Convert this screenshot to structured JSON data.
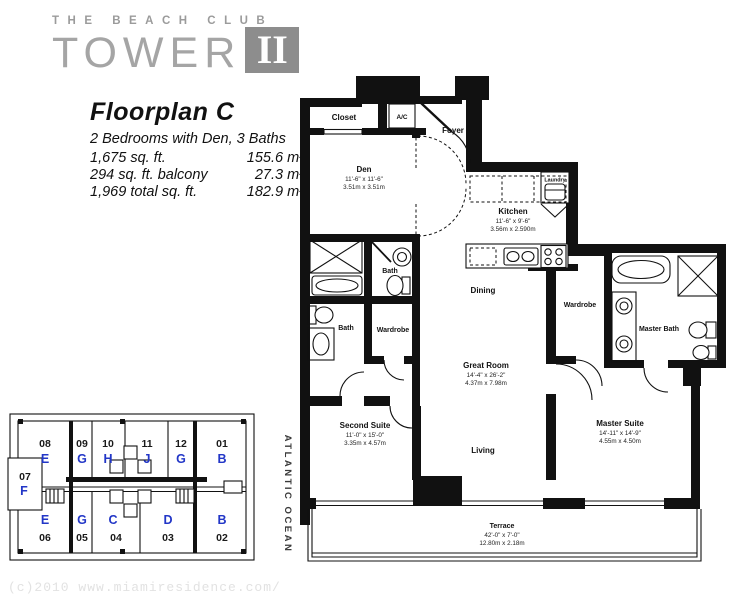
{
  "logo": {
    "tagline": "THE BEACH CLUB",
    "title": "TOWER",
    "numeral": "II"
  },
  "info": {
    "title": "Floorplan C",
    "subtitle": "2 Bedrooms with Den, 3 Baths",
    "area_rows": [
      {
        "left": "1,675 sq. ft.",
        "right": "155.6 m²"
      },
      {
        "left": "294 sq. ft. balcony",
        "right": "27.3 m²"
      },
      {
        "left": "1,969 total sq. ft.",
        "right": "182.9 m²"
      }
    ]
  },
  "plan": {
    "rooms": {
      "closet": {
        "name": "Closet"
      },
      "ac": {
        "name": "A/C"
      },
      "foyer": {
        "name": "Foyer"
      },
      "den": {
        "name": "Den",
        "dims_ft": "11'-6\" x 11'-6\"",
        "dims_m": "3.51m x 3.51m"
      },
      "kitchen": {
        "name": "Kitchen",
        "dims_ft": "11'-6\" x 9'-6\"",
        "dims_m": "3.56m x 2.590m"
      },
      "laundry": {
        "name": "Laundry"
      },
      "bath_upper": {
        "name": "Bath"
      },
      "bath_lower": {
        "name": "Bath"
      },
      "wardrobe_second": {
        "name": "Wardrobe"
      },
      "dining": {
        "name": "Dining"
      },
      "great_room": {
        "name": "Great Room",
        "dims_ft": "14'-4\" x 26'-2\"",
        "dims_m": "4.37m x 7.98m"
      },
      "living": {
        "name": "Living"
      },
      "second_suite": {
        "name": "Second Suite",
        "dims_ft": "11'-0\" x 15'-0\"",
        "dims_m": "3.35m x 4.57m"
      },
      "wardrobe_master": {
        "name": "Wardrobe"
      },
      "master_bath": {
        "name": "Master Bath"
      },
      "master_suite": {
        "name": "Master Suite",
        "dims_ft": "14'-11\" x 14'-9\"",
        "dims_m": "4.55m x 4.50m"
      },
      "terrace": {
        "name": "Terrace",
        "dims_ft": "42'-0\" x 7'-0\"",
        "dims_m": "12.80m x 2.18m"
      }
    },
    "ocean_label": "ATLANTIC OCEAN"
  },
  "keyplan": {
    "top_row": [
      {
        "num": "08",
        "letter": "E"
      },
      {
        "num": "09",
        "letter": "G"
      },
      {
        "num": "10",
        "letter": "H"
      },
      {
        "num": "11",
        "letter": "J"
      },
      {
        "num": "12",
        "letter": "G"
      },
      {
        "num": "01",
        "letter": "B"
      }
    ],
    "left_unit": {
      "num": "07",
      "letter": "F"
    },
    "bottom_row": [
      {
        "letter": "E",
        "num": "06"
      },
      {
        "letter": "G",
        "num": "05"
      },
      {
        "letter": "C",
        "num": "04"
      },
      {
        "letter": "D",
        "num": "03"
      },
      {
        "letter": "B",
        "num": "02"
      }
    ]
  },
  "watermark": "(c)2010 www.miamiresidence.com/",
  "colors": {
    "wall": "#111111",
    "unit_letter_blue": "#2236c7",
    "logo_gray": "#8d8d8d",
    "watermark_gray": "#e2e2e2"
  }
}
